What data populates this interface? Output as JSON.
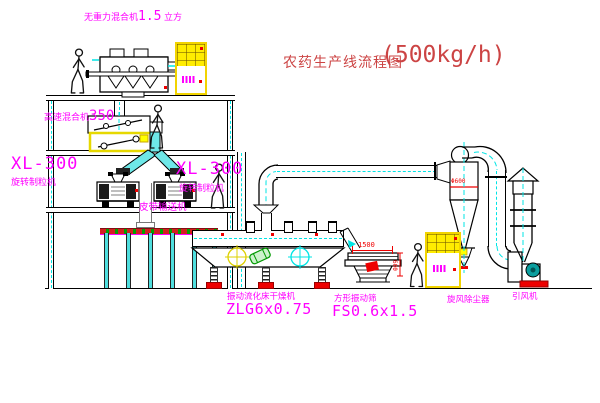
{
  "title": {
    "text": "农药生产线流程图",
    "capacity": "(500kg/h)"
  },
  "equipment_labels": {
    "gravity_mixer": {
      "name": "无重力混合机",
      "value": "1.5",
      "unit": "立方"
    },
    "high_speed_mixer": {
      "name": "高速混合机",
      "value": "350"
    },
    "granulator_left": {
      "model": "XL-300",
      "name": "旋转制粒机"
    },
    "granulator_right": {
      "model": "XL-300",
      "name": "旋转制粒机"
    },
    "belt_conveyor": {
      "name": "皮带输送机"
    },
    "fluid_bed_dryer": {
      "name": "振动流化床干燥机",
      "model": "ZLG6x0.75"
    },
    "vibrating_screen": {
      "name": "方形振动筛",
      "model": "FS0.6x1.5"
    },
    "cyclone": {
      "name": "旋风除尘器"
    },
    "fan": {
      "name": "引风机"
    }
  },
  "dimensions": {
    "screen_length": "1500",
    "screen_height": "600",
    "cyclone_note": "Φ600"
  },
  "colors": {
    "label_magenta": "#ff00ff",
    "title_red": "#cc4444",
    "dim_red": "#ee0000",
    "pipe_cyan": "#00e5e5",
    "highlight_yellow": "#ffec00"
  }
}
